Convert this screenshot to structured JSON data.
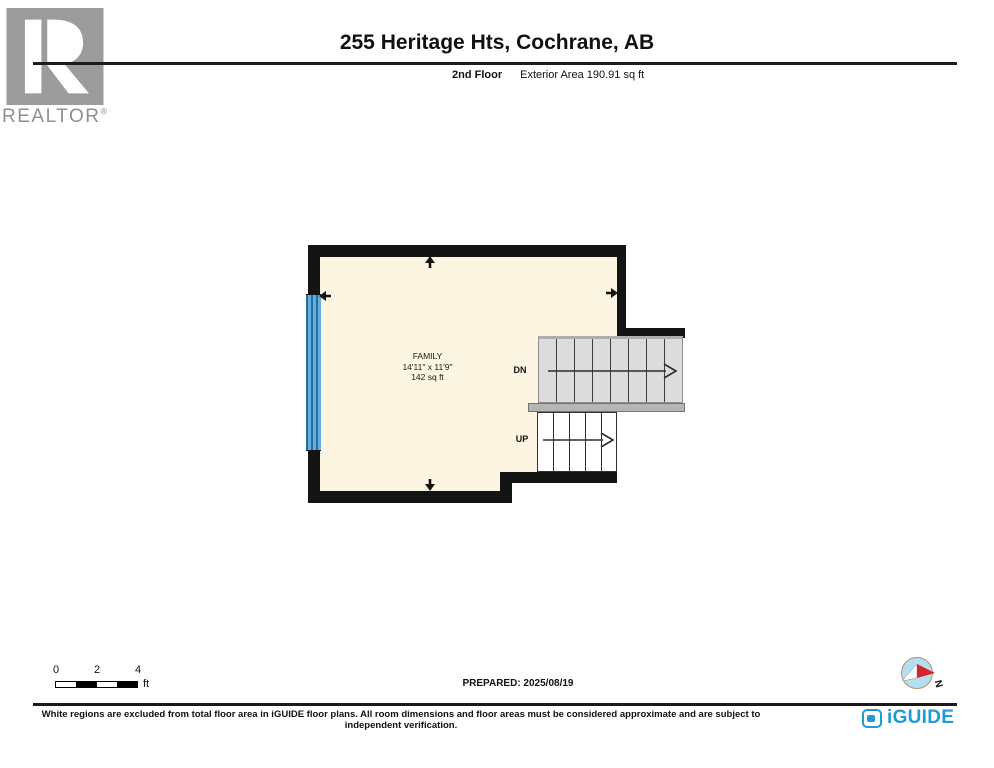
{
  "header": {
    "realtor_label": "REALTOR",
    "realtor_reg": "®",
    "title": "255 Heritage Hts, Cochrane, AB",
    "floor_label": "2nd Floor",
    "area_label": "Exterior Area 190.91 sq ft"
  },
  "plan": {
    "room": {
      "name": "FAMILY",
      "dimensions": "14'11\" x 11'9\"",
      "area": "142 sq ft"
    },
    "stair_down_label": "DN",
    "stair_up_label": "UP",
    "colors": {
      "floor_fill": "#fcf5e1",
      "wall": "#141414",
      "stair_fill": "#dcdcdc",
      "landing_fill": "#b5b5b5",
      "window_light": "#66add8",
      "window_dark": "#1e6fa6"
    }
  },
  "scale_bar": {
    "ticks": [
      "0",
      "2",
      "4"
    ],
    "unit": "ft"
  },
  "footer": {
    "prepared": "PREPARED: 2025/08/19",
    "compass_label": "N",
    "disclaimer": "White regions are excluded from total floor area in iGUIDE floor plans. All room dimensions and floor areas must be considered approximate and are subject to independent verification.",
    "brand": "iGUIDE",
    "brand_color": "#229ad2"
  }
}
